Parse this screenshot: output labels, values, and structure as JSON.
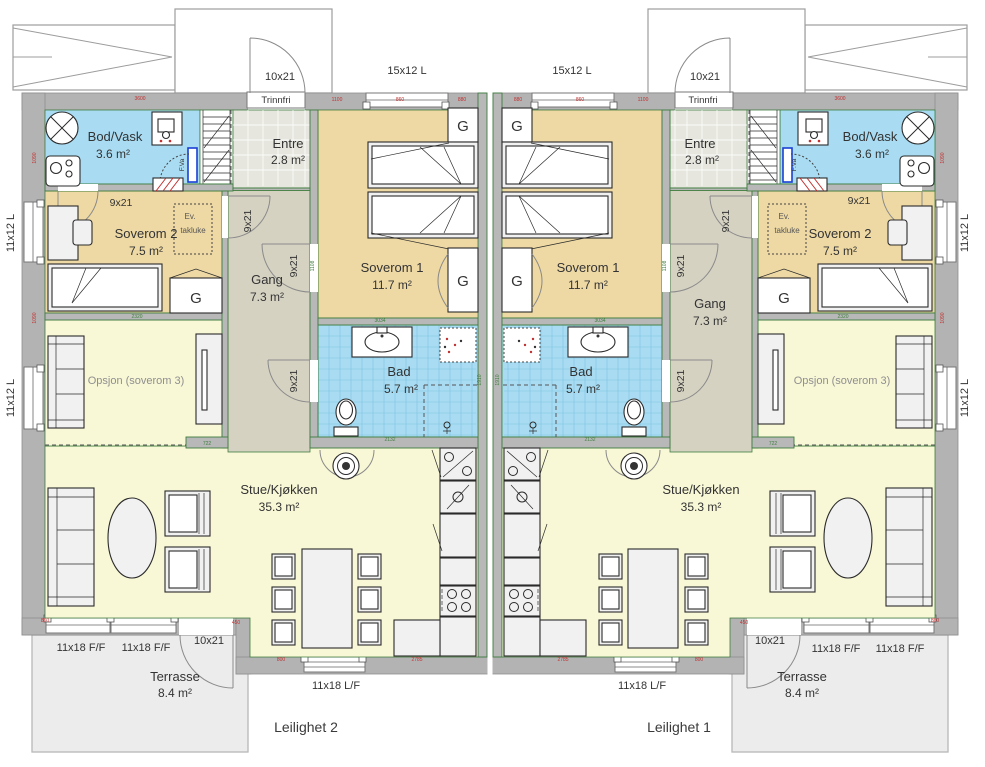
{
  "apartments": {
    "left": "Leilighet 2",
    "right": "Leilighet 1"
  },
  "rooms": {
    "bod": {
      "name": "Bod/Vask",
      "area": "3.6 m²"
    },
    "entre": {
      "name": "Entre",
      "area": "2.8 m²"
    },
    "sov2": {
      "name": "Soverom 2",
      "area": "7.5 m²"
    },
    "sov1": {
      "name": "Soverom 1",
      "area": "11.7 m²"
    },
    "gang": {
      "name": "Gang",
      "area": "7.3 m²"
    },
    "bad": {
      "name": "Bad",
      "area": "5.7 m²"
    },
    "opsjon": {
      "name": "Opsjon (soverom 3)"
    },
    "stue": {
      "name": "Stue/Kjøkken",
      "area": "35.3 m²"
    },
    "terrasse": {
      "name": "Terrasse",
      "area": "8.4 m²"
    }
  },
  "openings": {
    "front_door": "10x21",
    "trinnfri": "Trinnfri",
    "window_bedroom_top": "15x12 L",
    "window_side": "11x12 L",
    "interior_door": "9x21",
    "window_living_front": "11x18 F/F",
    "terrace_door": "10x21",
    "window_kitchen_front": "11x18 L/F"
  },
  "annotations": {
    "wardrobe": "G",
    "roof_hatch_1": "Ev.",
    "roof_hatch_2": "takluke",
    "water_cabinet": "F.Va"
  },
  "dims_red": [
    "3600",
    "1090",
    "1100",
    "860",
    "880",
    "450",
    "800",
    "2785"
  ],
  "dims_green": [
    "2320",
    "722",
    "3034",
    "2132",
    "1108",
    "1910"
  ],
  "colors": {
    "wet_room": "#a9dcf2",
    "bedroom": "#eed9a4",
    "living": "#f8f7d6",
    "hall": "#d5d2c2",
    "entre_floor": "#e6e6de",
    "wall": "#b3b3b3",
    "wall_edge": "#3f7d3f",
    "terrace": "#ececec",
    "dim_red": "#c23030",
    "water_cabinet_blue": "#1a3fd4"
  }
}
